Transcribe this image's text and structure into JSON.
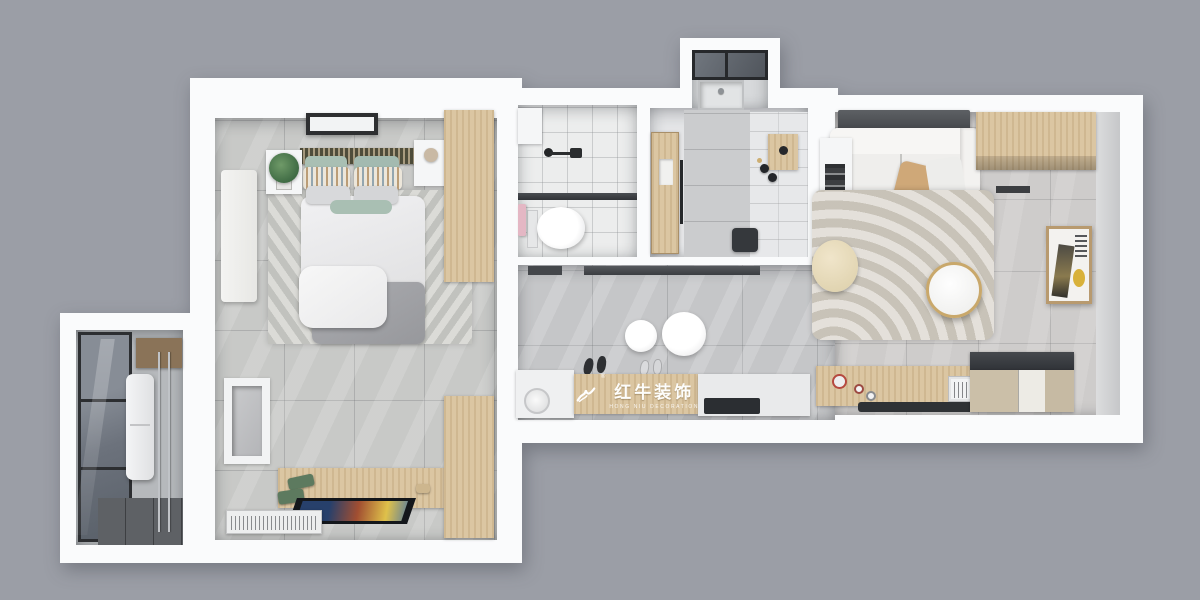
{
  "scene": {
    "description": "Top-down 3D rendered floor plan of a small apartment on a plain gray backdrop",
    "background_color": "#9b9ea6",
    "wall_color": "#fafbfc"
  },
  "watermark": {
    "brand": "红牛装饰",
    "subtitle": "HONG NIU DECORATION",
    "registered_mark": "®",
    "logo_icon": "bull-swoosh-logo",
    "text_color": "#ffffff"
  },
  "palette": {
    "background": "#9b9ea6",
    "wall_white": "#fafbfc",
    "wood": "#d9c29c",
    "bedroom_floor": "#c8c9c7",
    "kitchen_floor": "#c5c6c8",
    "living_floor": "#cecccb",
    "rug_beige": "#d5d0c6",
    "sage_green": "#a9bfb3",
    "glass_dark": "#596069",
    "accent_gold": "#c9a86b",
    "towel_pink": "#e4b7c4"
  },
  "rooms": [
    {
      "id": "bedroom",
      "area": "top-left",
      "furniture": [
        "ceiling-light",
        "double-bed",
        "sage-pillows",
        "striped-pillows",
        "gray-pillows",
        "chevron-rug",
        "bed-tray",
        "nightstand-left",
        "potted-plant",
        "nightstand-right",
        "wardrobe-top",
        "wall-towel",
        "wall-niche",
        "tv-cabinet",
        "flat-tv",
        "ac-unit",
        "wardrobe-bottom"
      ]
    },
    {
      "id": "balcony",
      "area": "bottom-left",
      "furniture": [
        "glazed-window",
        "water-heater",
        "drying-rack-poles",
        "wall-shelf",
        "dark-tile-floor"
      ]
    },
    {
      "id": "bathroom",
      "area": "top-center",
      "furniture": [
        "wall-cabinet",
        "shower-set",
        "glass-partition",
        "toilet",
        "pink-towel"
      ]
    },
    {
      "id": "entry-hall",
      "area": "top-center-right",
      "furniture": [
        "wood-door",
        "door-handle",
        "glazed-alcove",
        "utility-sink",
        "shoe-stand",
        "bottles",
        "waste-bin"
      ]
    },
    {
      "id": "kitchen-corridor",
      "area": "center",
      "furniture": [
        "window-strip",
        "pendant-lamp-small",
        "pendant-lamp-large",
        "dark-slippers",
        "light-slippers",
        "sink-counter",
        "wood-cabinet",
        "cooktop"
      ]
    },
    {
      "id": "living-dining",
      "area": "right",
      "furniture": [
        "ac-panel",
        "sofa",
        "tan-pillow",
        "white-pillow",
        "gray-throw",
        "ladder-shelf",
        "corner-cabinet",
        "ripple-rug",
        "pouf",
        "round-coffee-table",
        "wall-artwork",
        "floor-vent",
        "dining-table",
        "dining-bench",
        "tea-set",
        "kitchen-appliance",
        "sideboard"
      ]
    }
  ]
}
